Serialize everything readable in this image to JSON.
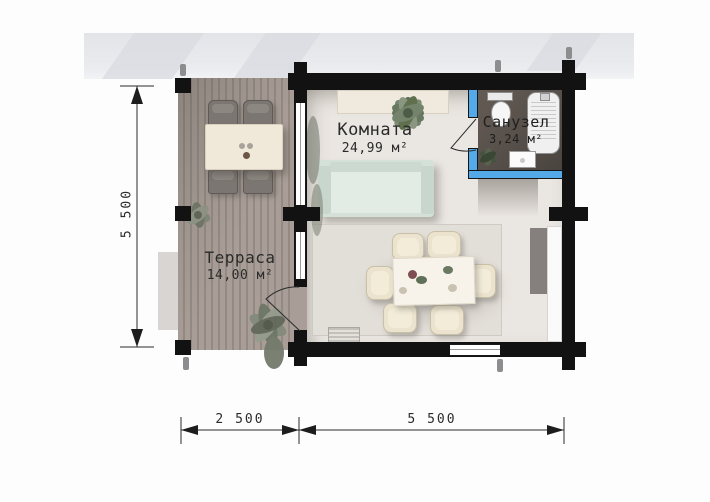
{
  "page": {
    "type": "architectural floor plan"
  },
  "rooms": {
    "room": {
      "name": "Комната",
      "area": "24,99 м²"
    },
    "terrace": {
      "name": "Терраса",
      "area": "14,00 м²"
    },
    "bathroom": {
      "name": "Санузел",
      "area": "3,24 м²"
    }
  },
  "dimensions": {
    "left_height": "5 500",
    "bottom_terrace_width": "2 500",
    "bottom_house_width": "5 500"
  },
  "colors": {
    "wall": "#121212",
    "partition_wall": "#54a9e8",
    "deck": "#a89e97",
    "room_floor": "#eae6e1",
    "bathroom_floor": "#554e48",
    "sofa": "#d4e0d8",
    "chair": "#ebe3cd",
    "dimension_line": "#2b2b2b"
  },
  "icons": [
    "sofa",
    "dining-table",
    "dining-chair",
    "terrace-table",
    "terrace-chair",
    "toilet",
    "bathtub",
    "sink",
    "plant",
    "rug",
    "doormat",
    "door-swing",
    "window",
    "corner-post"
  ]
}
